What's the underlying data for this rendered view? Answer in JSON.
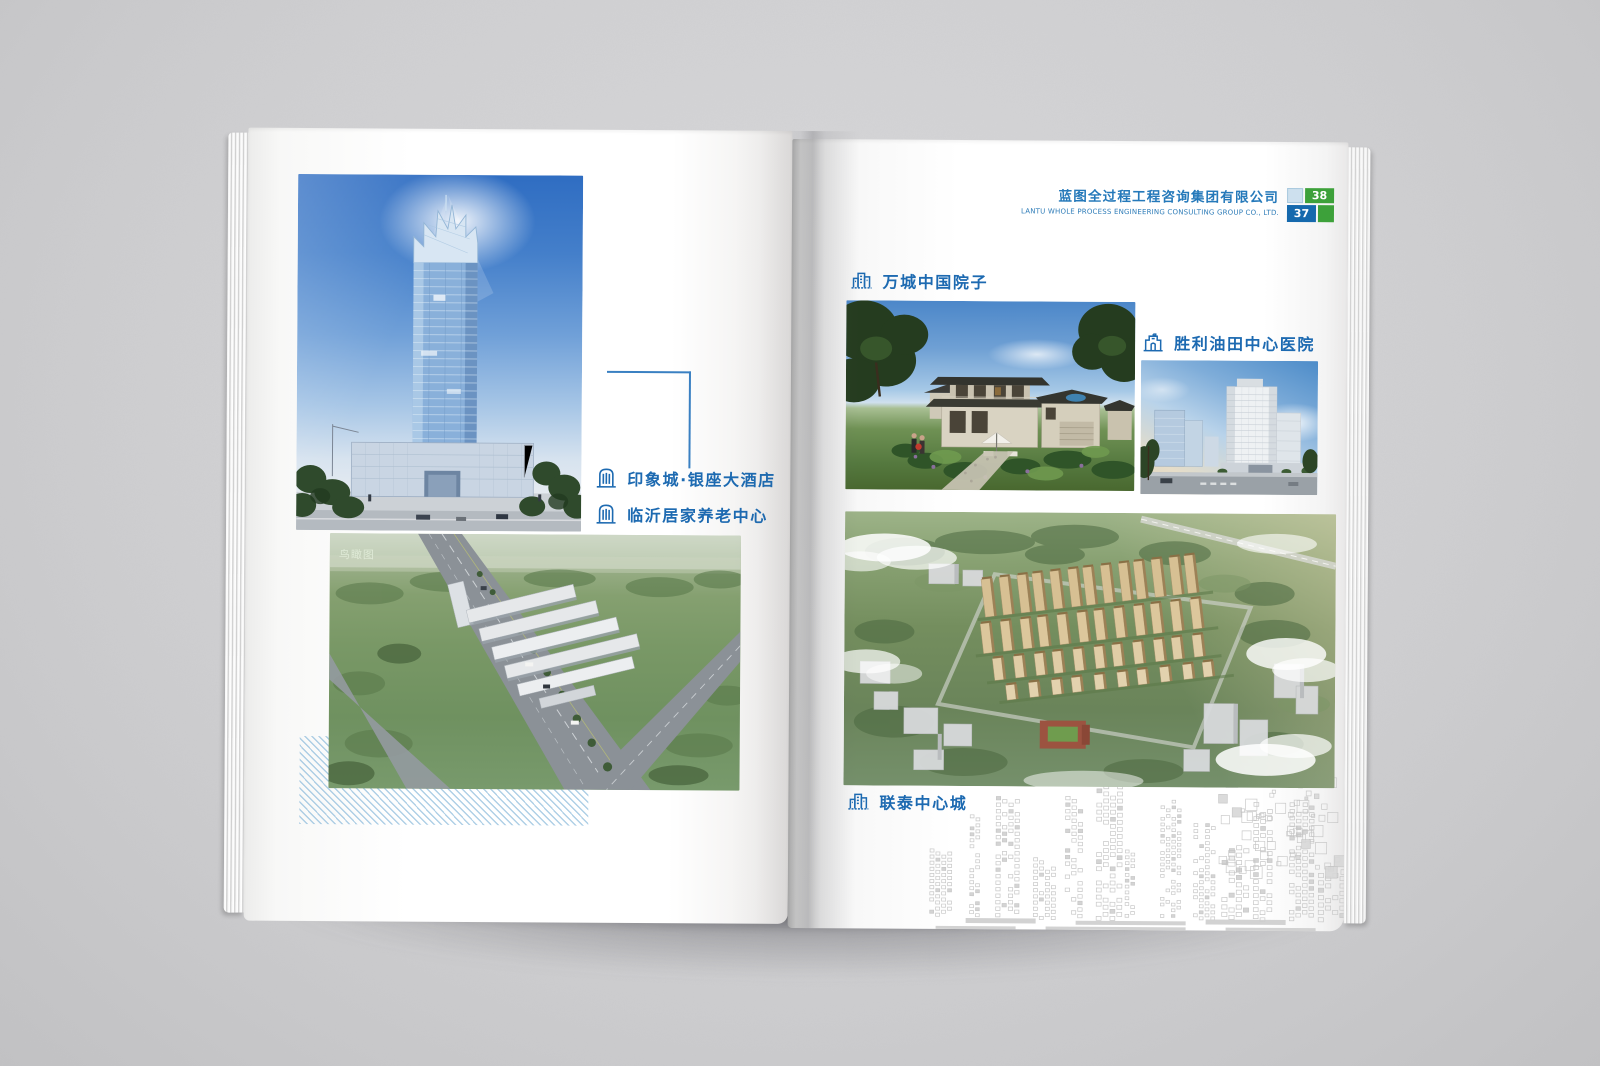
{
  "header": {
    "company_cn": "蓝图全过程工程咨询集团有限公司",
    "company_en": "LANTU WHOLE PROCESS ENGINEERING CONSULTING GROUP CO., LTD.",
    "page_left": "37",
    "page_right": "38"
  },
  "left_page": {
    "projects": [
      {
        "label": "印象城·银座大酒店",
        "icon": "arched-building-icon"
      },
      {
        "label": "临沂居家养老中心",
        "icon": "arched-building-icon"
      }
    ],
    "aerial_caption": "鸟瞰图"
  },
  "right_page": {
    "projects": [
      {
        "label": "万城中国院子",
        "icon": "city-buildings-icon"
      },
      {
        "label": "胜利油田中心医院",
        "icon": "hospital-building-icon"
      },
      {
        "label": "联泰中心城",
        "icon": "city-buildings-icon"
      }
    ]
  },
  "colors": {
    "label_blue": "#1d6ab1",
    "header_blue": "#2579ba",
    "badge_blue": "#1569ad",
    "badge_green": "#3da13a",
    "hatch_blue": "#7ab0d6",
    "background_gray": "#d0d0d2"
  }
}
